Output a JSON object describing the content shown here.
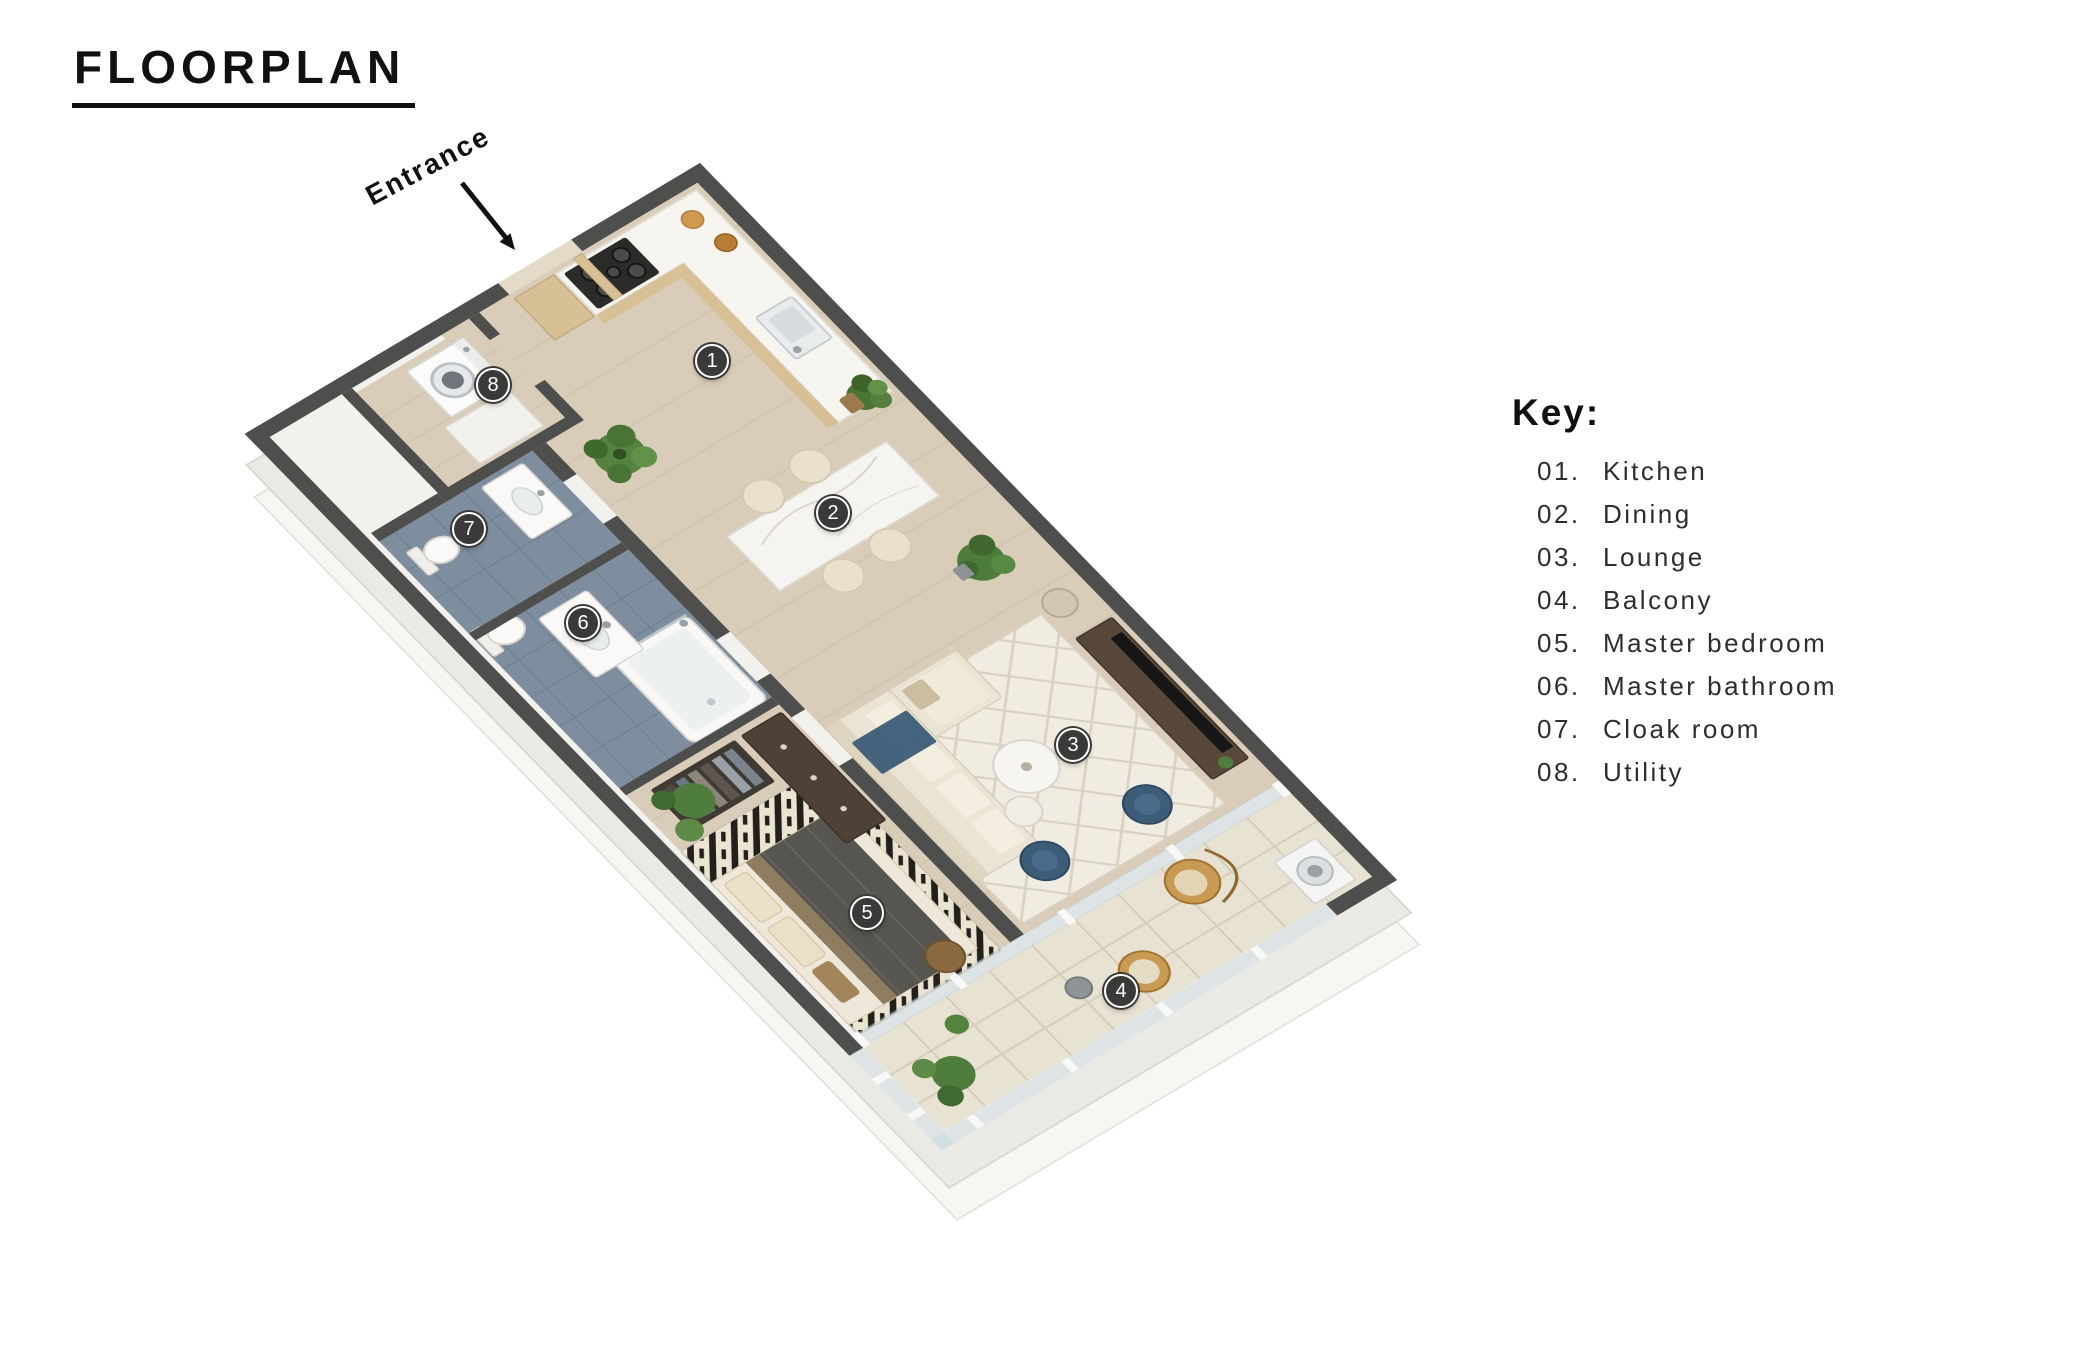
{
  "title": "FLOORPLAN",
  "entrance_label": "Entrance",
  "key": {
    "heading": "Key:",
    "items": [
      {
        "num": "01.",
        "label": "Kitchen"
      },
      {
        "num": "02.",
        "label": "Dining"
      },
      {
        "num": "03.",
        "label": "Lounge"
      },
      {
        "num": "04.",
        "label": "Balcony"
      },
      {
        "num": "05.",
        "label": "Master bedroom"
      },
      {
        "num": "06.",
        "label": "Master bathroom"
      },
      {
        "num": "07.",
        "label": "Cloak room"
      },
      {
        "num": "08.",
        "label": "Utility"
      }
    ]
  },
  "floorplan": {
    "markers": [
      {
        "number": "1",
        "room": "Kitchen"
      },
      {
        "number": "2",
        "room": "Dining"
      },
      {
        "number": "3",
        "room": "Lounge"
      },
      {
        "number": "4",
        "room": "Balcony"
      },
      {
        "number": "5",
        "room": "Master bedroom"
      },
      {
        "number": "6",
        "room": "Master bathroom"
      },
      {
        "number": "7",
        "room": "Cloak room"
      },
      {
        "number": "8",
        "room": "Utility"
      }
    ]
  },
  "colors": {
    "ink": "#111111",
    "text": "#2e2e2e",
    "wall": "#4e4e4c",
    "wood_floor": "#d9cdb9",
    "slate_floor": "#7e8e9e",
    "balcony_floor": "#e8e2d3",
    "marker_bg": "#3b3a38",
    "counter_wood": "#d8c096",
    "accent_blue": "#3d5c78",
    "plant_green": "#4f7d3d",
    "rattan": "#c89a54"
  }
}
